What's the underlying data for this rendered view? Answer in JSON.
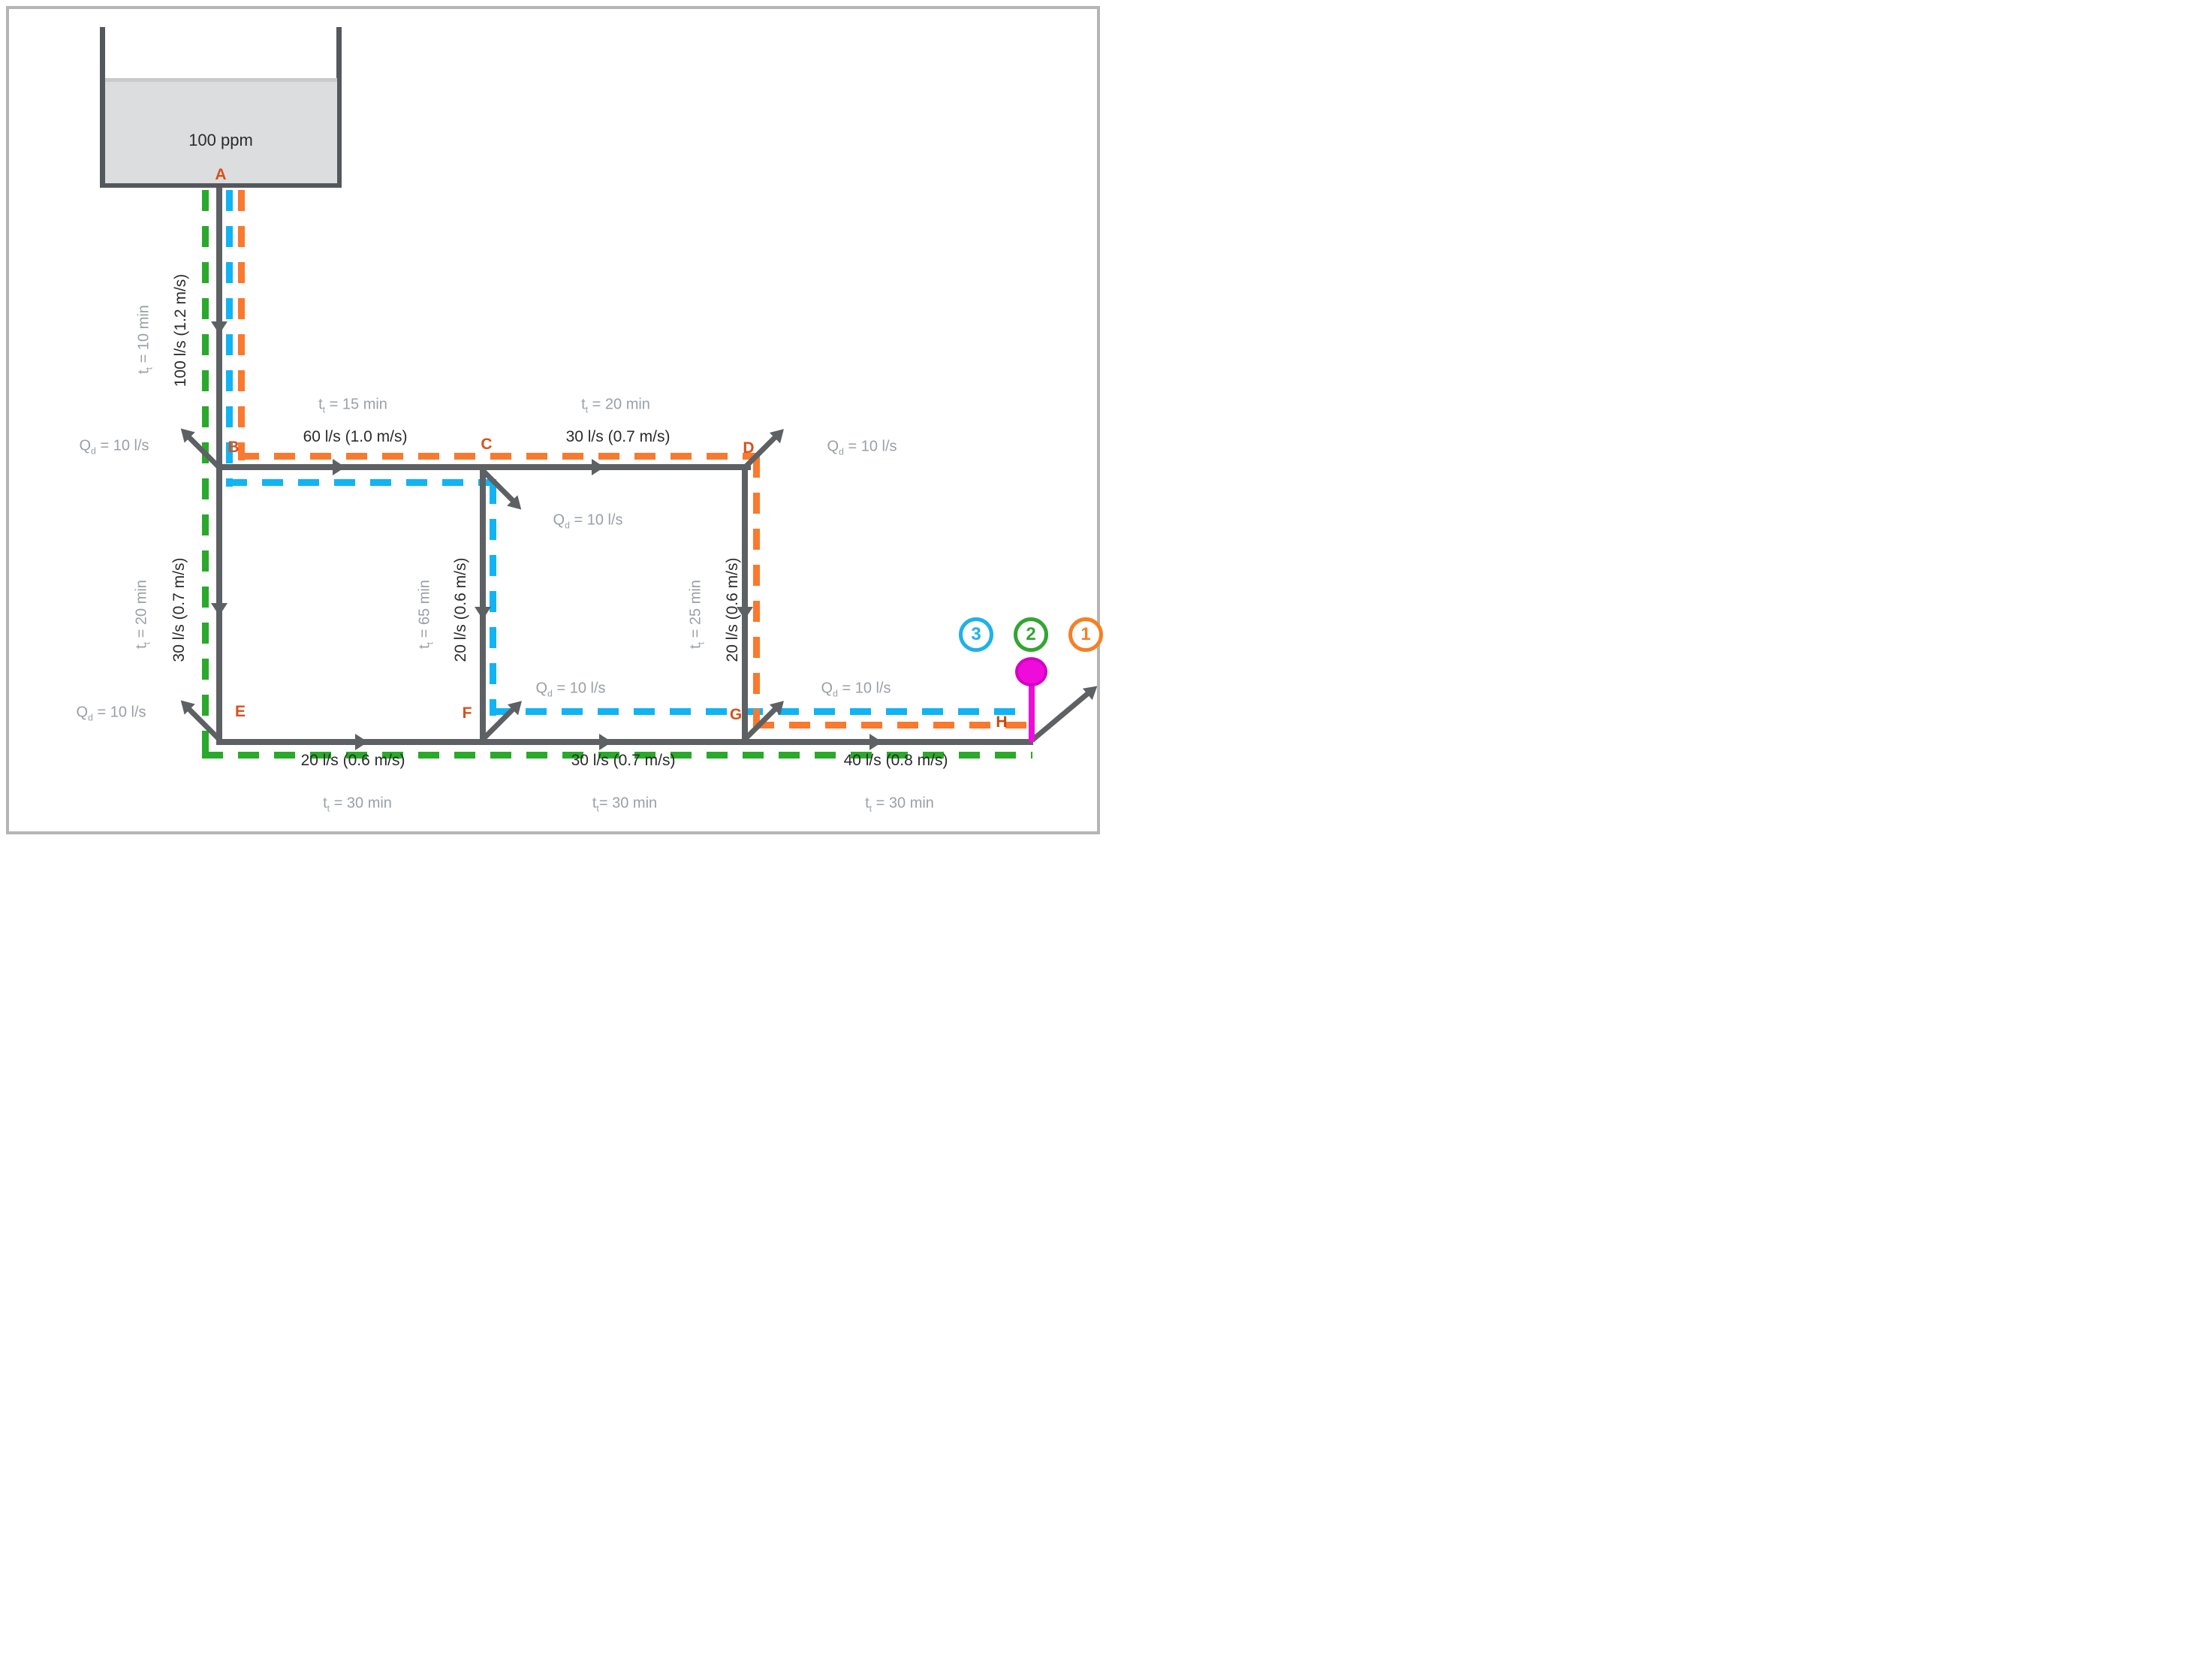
{
  "tank": {
    "concentration": "100 ppm"
  },
  "nodes": {
    "A": "A",
    "B": "B",
    "C": "C",
    "D": "D",
    "E": "E",
    "F": "F",
    "G": "G",
    "H": "H"
  },
  "pipes": {
    "AB": {
      "flow": "100 l/s (1.2 m/s)",
      "tt": {
        "pre": "t",
        "sub": "t",
        "post": " = 10 min"
      }
    },
    "BC": {
      "flow": "60 l/s (1.0 m/s)",
      "tt": {
        "pre": "t",
        "sub": "t",
        "post": " = 15 min"
      }
    },
    "CD": {
      "flow": "30 l/s (0.7 m/s)",
      "tt": {
        "pre": "t",
        "sub": "t",
        "post": " = 20 min"
      }
    },
    "BE": {
      "flow": "30 l/s (0.7 m/s)",
      "tt": {
        "pre": "t",
        "sub": "t",
        "post": " = 20 min"
      }
    },
    "CF": {
      "flow": "20 l/s (0.6 m/s)",
      "tt": {
        "pre": "t",
        "sub": "t",
        "post": " = 65 min"
      }
    },
    "DG": {
      "flow": "20 l/s (0.6 m/s)",
      "tt": {
        "pre": "t",
        "sub": "t",
        "post": " = 25 min"
      }
    },
    "EF": {
      "flow": "20 l/s (0.6 m/s)",
      "tt": {
        "pre": "t",
        "sub": "t",
        "post": " = 30 min"
      }
    },
    "FG": {
      "flow": "30 l/s (0.7 m/s)",
      "tt": {
        "pre": "t",
        "sub": "t",
        "post": "= 30 min"
      }
    },
    "GH": {
      "flow": "40 l/s (0.8 m/s)",
      "tt": {
        "pre": "t",
        "sub": "t",
        "post": " = 30 min"
      }
    }
  },
  "demands": {
    "B": {
      "pre": "Q",
      "sub": "d",
      "post": " = 10 l/s"
    },
    "C": {
      "pre": "Q",
      "sub": "d",
      "post": " = 10 l/s"
    },
    "D": {
      "pre": "Q",
      "sub": "d",
      "post": " = 10 l/s"
    },
    "E": {
      "pre": "Q",
      "sub": "d",
      "post": " = 10 l/s"
    },
    "F": {
      "pre": "Q",
      "sub": "d",
      "post": " = 10 l/s"
    },
    "G": {
      "pre": "Q",
      "sub": "d",
      "post": " = 10 l/s"
    }
  },
  "paths": [
    {
      "number": "3",
      "color": "#1fb1ea",
      "line_color": "#10b4f3"
    },
    {
      "number": "2",
      "color": "#33a532",
      "line_color": "#2aa92a"
    },
    {
      "number": "1",
      "color": "#f58025",
      "line_color": "#f9792e"
    }
  ],
  "pin": {
    "location": "H",
    "color": "#ef0cdb"
  },
  "colors": {
    "frame": "#b5b5b5",
    "pipe": "#5d6164",
    "tank_wall": "#54585c",
    "tank_water": "#dcdddf",
    "black_text": "#2b2b2b",
    "gray_text": "#9aa0a6",
    "node_label": "#d8511a",
    "node_label_h": "#c8490c",
    "path_green": "#2aa92a",
    "path_blue": "#10b4f3",
    "path_orange": "#f9792e",
    "badge_blue": "#1fb1ea",
    "badge_green": "#33a532",
    "badge_orange": "#f58025",
    "pin": "#ef0cdb",
    "pin_dark": "#d401c2"
  }
}
